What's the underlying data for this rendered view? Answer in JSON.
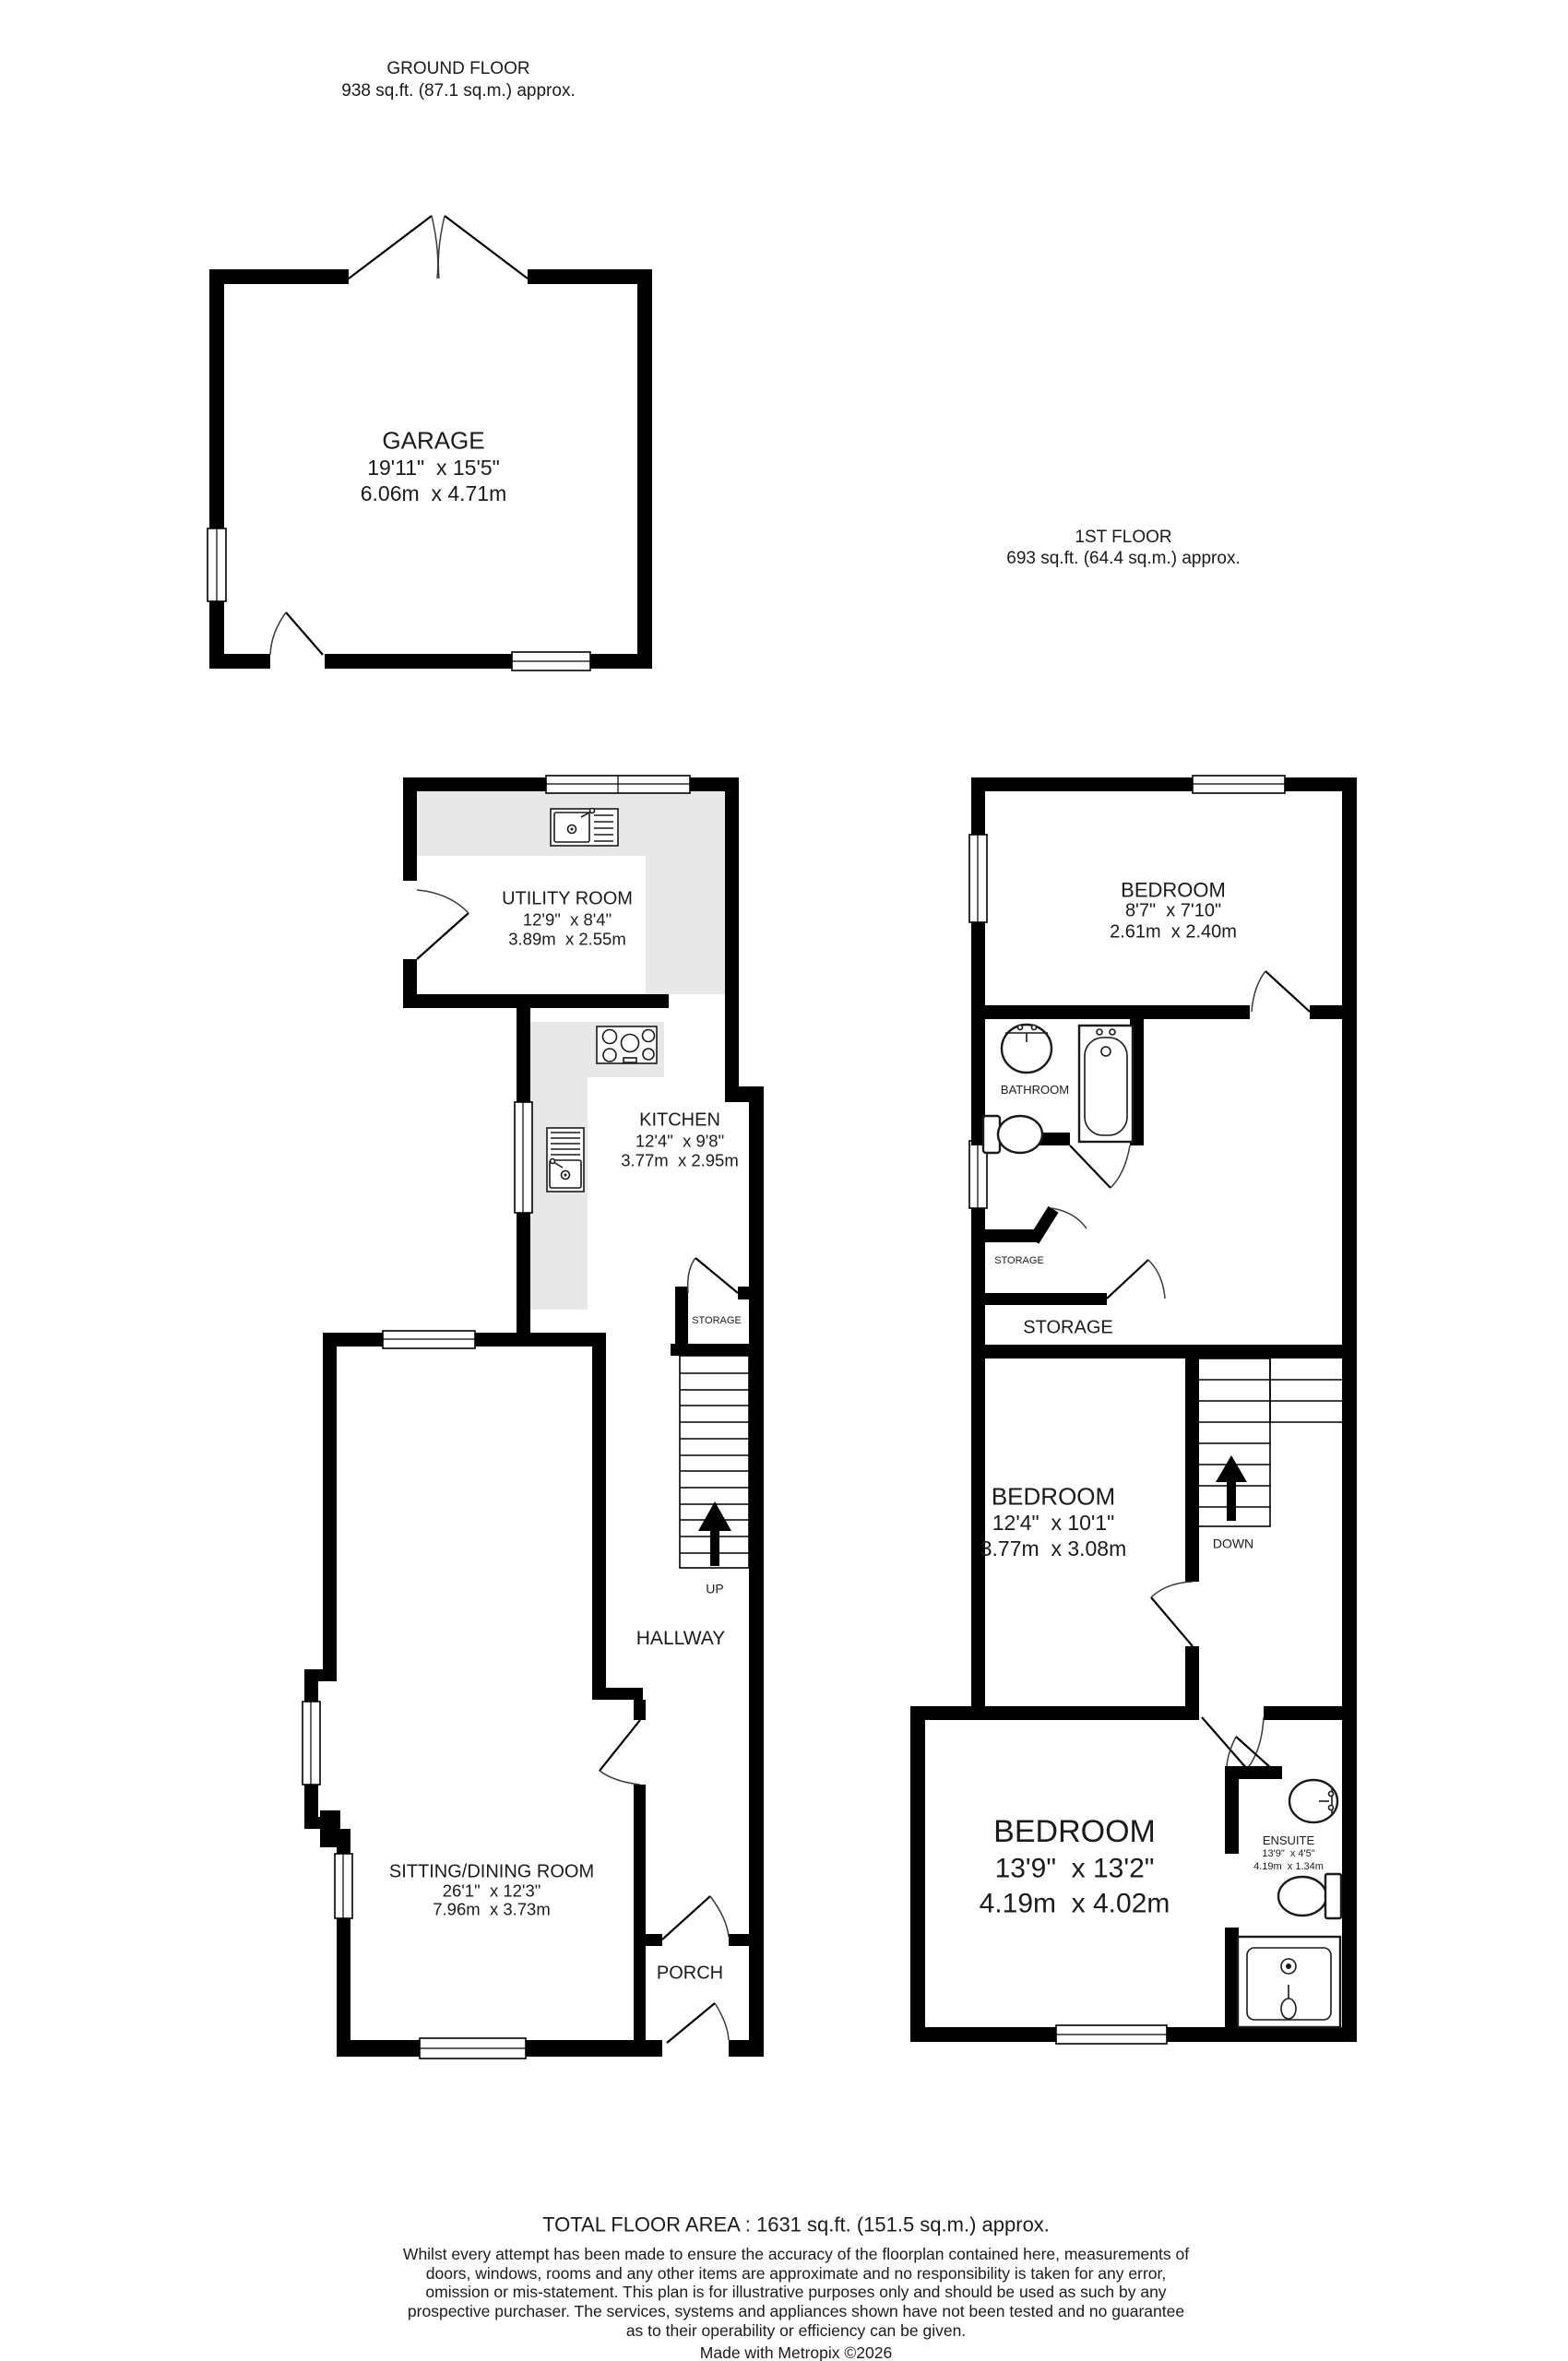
{
  "colors": {
    "wall": "#000000",
    "counter": "#e8e8e8",
    "text": "#1b1b1b",
    "background": "#ffffff"
  },
  "headers": {
    "ground": {
      "title": "GROUND FLOOR",
      "area": "938 sq.ft. (87.1 sq.m.) approx."
    },
    "first": {
      "title": "1ST FLOOR",
      "area": "693 sq.ft. (64.4 sq.m.) approx."
    }
  },
  "rooms": {
    "garage": {
      "name": "GARAGE",
      "imperial": "19'11\"  x 15'5\"",
      "metric": "6.06m  x 4.71m"
    },
    "utility": {
      "name": "UTILITY ROOM",
      "imperial": "12'9\"  x 8'4\"",
      "metric": "3.89m  x 2.55m"
    },
    "kitchen": {
      "name": "KITCHEN",
      "imperial": "12'4\"  x 9'8\"",
      "metric": "3.77m  x 2.95m"
    },
    "sitting": {
      "name": "SITTING/DINING ROOM",
      "imperial": "26'1\"  x 12'3\"",
      "metric": "7.96m  x 3.73m"
    },
    "hallway": {
      "name": "HALLWAY"
    },
    "porch": {
      "name": "PORCH"
    },
    "storage_gf": {
      "name": "STORAGE"
    },
    "bedroom_top": {
      "name": "BEDROOM",
      "imperial": "8'7\"  x 7'10\"",
      "metric": "2.61m  x 2.40m"
    },
    "bathroom": {
      "name": "BATHROOM"
    },
    "storage_ff_closet": {
      "name": "STORAGE"
    },
    "storage_ff": {
      "name": "STORAGE"
    },
    "bedroom_mid": {
      "name": "BEDROOM",
      "imperial": "12'4\"  x 10'1\"",
      "metric": "3.77m  x 3.08m"
    },
    "bedroom_big": {
      "name": "BEDROOM",
      "imperial": "13'9\"  x 13'2\"",
      "metric": "4.19m  x 4.02m"
    },
    "ensuite": {
      "name": "ENSUITE",
      "imperial": "13'9\"  x 4'5\"",
      "metric": "4.19m  x 1.34m"
    }
  },
  "stairs": {
    "up": "UP",
    "down": "DOWN"
  },
  "icons": [
    "utility-sink-icon",
    "kitchen-hob-icon",
    "kitchen-sink-icon",
    "bathroom-basin-icon",
    "bathroom-toilet-icon",
    "bathtub-icon",
    "ensuite-basin-icon",
    "ensuite-toilet-icon",
    "shower-icon",
    "stairs-up-arrow-icon",
    "stairs-down-arrow-icon"
  ],
  "footer": {
    "total": "TOTAL FLOOR AREA : 1631 sq.ft. (151.5 sq.m.) approx.",
    "disclaimer": "Whilst every attempt has been made to ensure the accuracy of the floorplan contained here, measurements of doors, windows, rooms and any other items are approximate and no responsibility is taken for any error, omission or mis-statement. This plan is for illustrative purposes only and should be used as such by any prospective purchaser. The services, systems and appliances shown have not been tested and no guarantee as to their operability or efficiency can be given.",
    "credit": "Made with Metropix ©2026"
  }
}
